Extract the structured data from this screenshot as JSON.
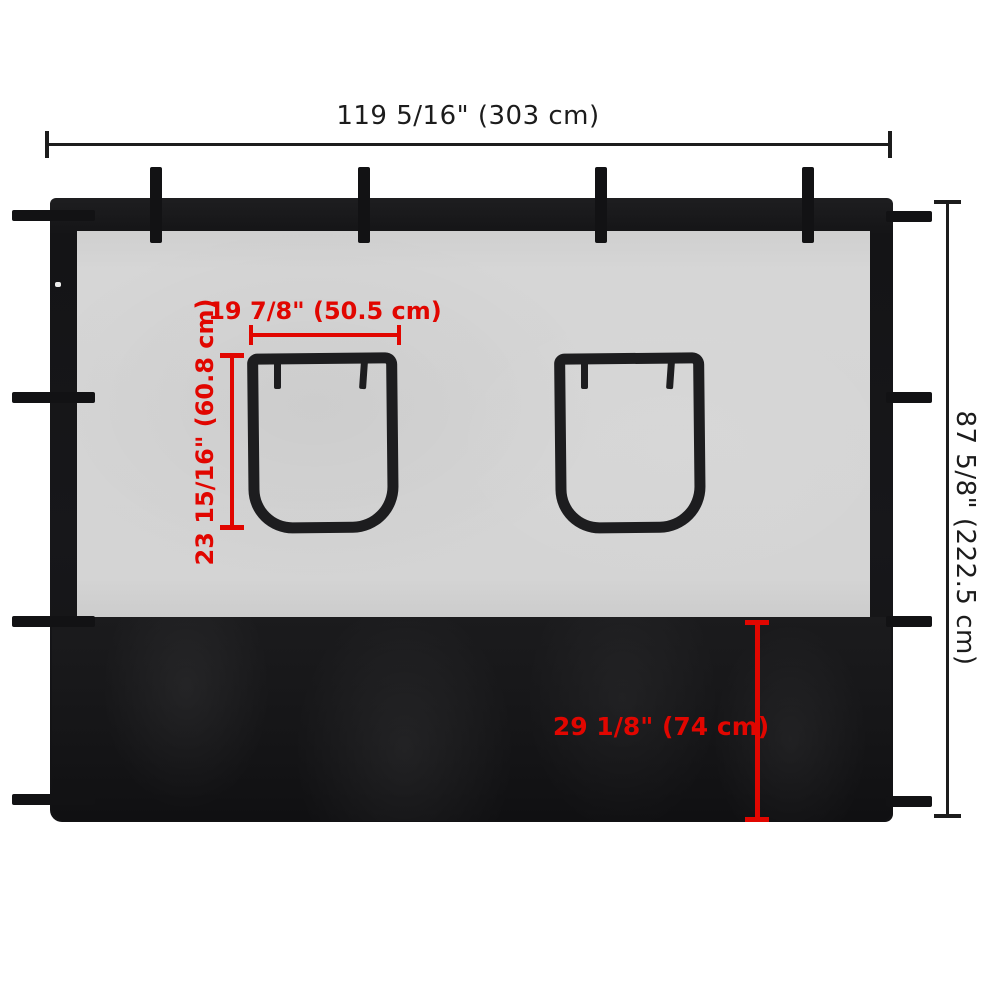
{
  "colors": {
    "ink": "#1c1c1c",
    "red": "#e10600",
    "fabric": "#18181a",
    "mesh": "#d4d4d4",
    "frame": "#1d1d1f",
    "bg": "#ffffff"
  },
  "diagram": {
    "subject": "gazebo sidewall panel with two windows and privacy skirt",
    "dimensions": {
      "overall_width": {
        "label": "119 5/16\" (303 cm)",
        "inches": "119 5/16\"",
        "cm": "303 cm"
      },
      "overall_height": {
        "label": "87 5/8\" (222.5 cm)",
        "inches": "87 5/8\"",
        "cm": "222.5 cm"
      },
      "window_width": {
        "label": "19 7/8\" (50.5 cm)",
        "inches": "19 7/8\"",
        "cm": "50.5 cm"
      },
      "window_height": {
        "label": "23 15/16\" (60.8 cm)",
        "inches": "23 15/16\"",
        "cm": "60.8 cm"
      },
      "skirt_height": {
        "label": "29 1/8\" (74 cm)",
        "inches": "29 1/8\"",
        "cm": "74 cm"
      }
    }
  }
}
